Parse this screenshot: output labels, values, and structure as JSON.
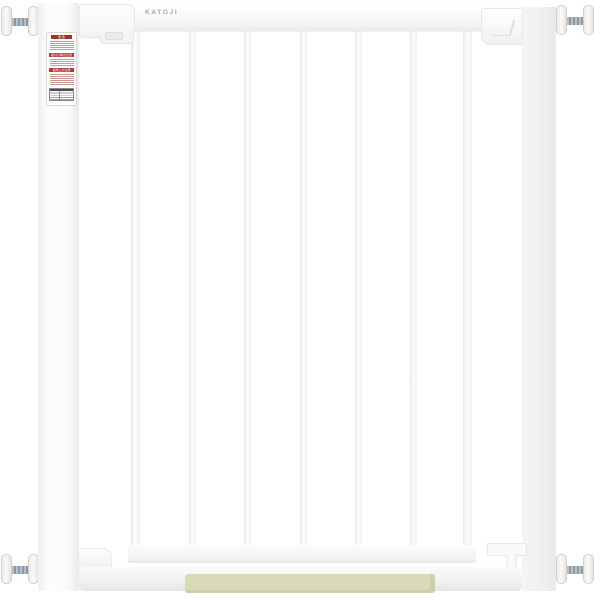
{
  "product": {
    "brand_label": "KATOJI",
    "type": "pressure-mounted white baby safety gate",
    "bars_count": 7
  },
  "colors": {
    "gate_white": "#fbfbfb",
    "edge_gray": "#e8e8e8",
    "right_post_gray": "#f0f0f1",
    "spindle_metal": "#8d98a6",
    "disc_white": "#f3f1ec",
    "step_pad_green": "#d8dbb6",
    "warning_red": "#b23a34",
    "warning_red_dark": "#a32f2a",
    "brand_text_gray": "#a6a6a6"
  },
  "warning_label": {
    "section1_header": "警 告",
    "section2_header": "取付け時の注意",
    "section3_header": "使用上の注意"
  }
}
